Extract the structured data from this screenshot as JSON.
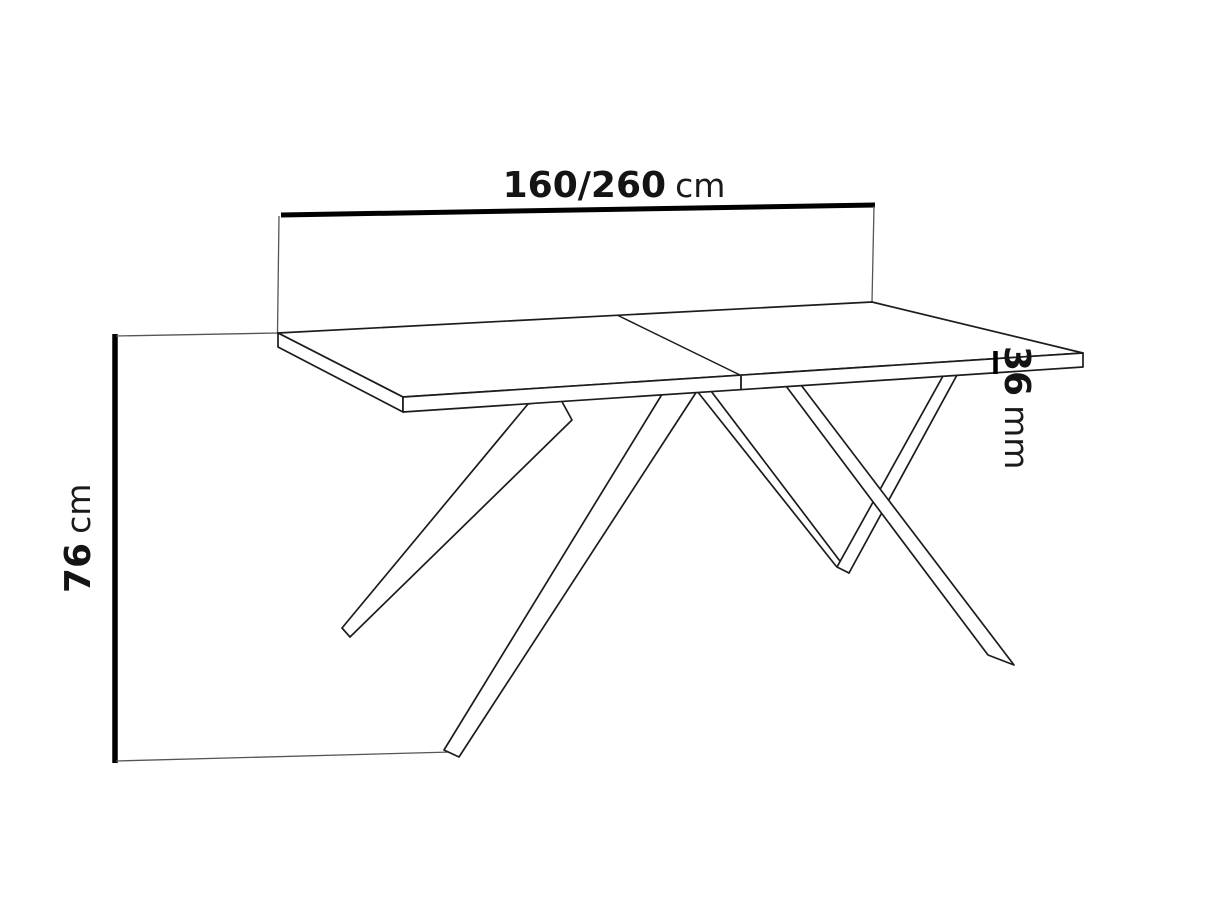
{
  "diagram": {
    "type": "furniture-dimension-line-drawing",
    "subject": "extendable table with split top and splayed spider legs",
    "dimensions": {
      "length": {
        "value": "160/260",
        "unit": "cm",
        "position": "top-horizontal"
      },
      "height": {
        "value": "76",
        "unit": "cm",
        "position": "left-vertical-rotated"
      },
      "thickness": {
        "value": "36",
        "unit": "mm",
        "position": "right-vertical-rotated"
      }
    },
    "colors": {
      "background": "#ffffff",
      "outline": "#1c1c1c",
      "dimension_line": "#000000",
      "extension_line": "#666666"
    }
  }
}
